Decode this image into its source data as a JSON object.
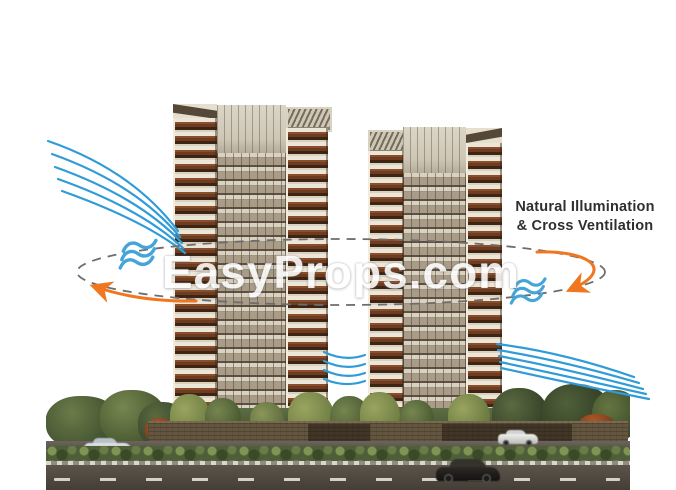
{
  "watermark": {
    "text": "EasyProps.com"
  },
  "callout": {
    "line1": "Natural Illumination",
    "line2": "& Cross Ventilation"
  },
  "icons": {
    "wind": "wind-waves-icon",
    "airflow_path": "dashed-airflow-ellipse-icon",
    "airflow_arrows": "curved-airflow-arrow-icon"
  },
  "colors": {
    "wind_line": "#2f9bd8",
    "wind_icon": "#45a5d8",
    "arrow": "#f0771f",
    "ellipse": "#6d6d6d",
    "label_text": "#2e2f33",
    "watermark_text": "#ffffff"
  }
}
